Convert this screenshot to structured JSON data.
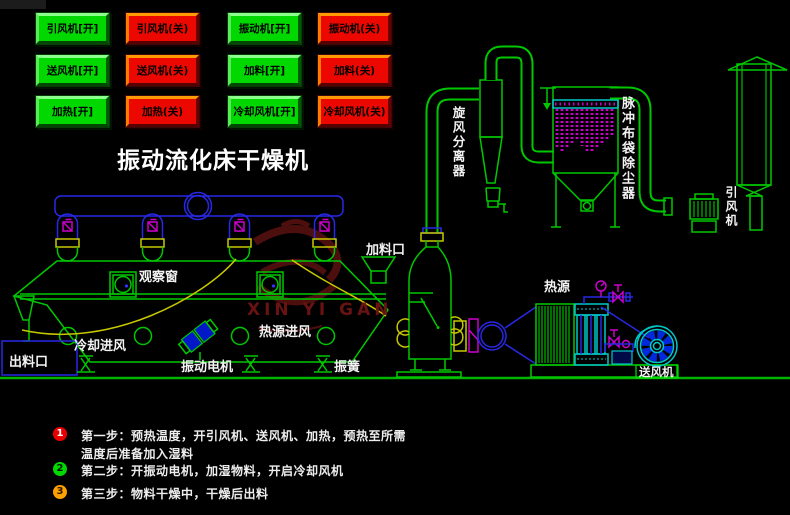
{
  "title": "振动流化床干燥机",
  "control_panel": {
    "on_color": "#00d800",
    "off_color": "#ec0800",
    "buttons": [
      {
        "label": "引风机[开]",
        "state": "on"
      },
      {
        "label": "引风机(关)",
        "state": "off"
      },
      {
        "label": "振动机[开]",
        "state": "on"
      },
      {
        "label": "振动机(关)",
        "state": "off"
      },
      {
        "label": "送风机[开]",
        "state": "on"
      },
      {
        "label": "送风机(关)",
        "state": "off"
      },
      {
        "label": "加料[开]",
        "state": "on"
      },
      {
        "label": "加料(关)",
        "state": "off"
      },
      {
        "label": "加热[开]",
        "state": "on"
      },
      {
        "label": "加热(关)",
        "state": "off"
      },
      {
        "label": "冷却风机[开]",
        "state": "on"
      },
      {
        "label": "冷却风机(关)",
        "state": "off"
      }
    ]
  },
  "equipment_labels": {
    "observation_window": "观察窗",
    "feed_port": "加料口",
    "cooling_air_inlet": "冷却进风",
    "heat_air_inlet": "热源进风",
    "vibration_motor": "振动电机",
    "discharge_port": "出料口",
    "vibration_spring": "振簧",
    "heat_source": "热源",
    "blower_fan": "送风机",
    "cyclone_separator": "旋风分离器",
    "pulse_bag_filter": "脉冲布袋除尘器",
    "induced_draft_fan": "引风机"
  },
  "watermark": {
    "text": "XIN YI GAN"
  },
  "steps": [
    {
      "num": "1",
      "badge_color": "#e80000",
      "lines": [
        "第一步：预热温度，开引风机、送风机、加热，预热至所需",
        "温度后准备加入湿料"
      ]
    },
    {
      "num": "2",
      "badge_color": "#00d800",
      "lines": [
        "第二步：开振动电机，加湿物料，开启冷却风机"
      ]
    },
    {
      "num": "3",
      "badge_color": "#ffa000",
      "lines": [
        "第三步：物料干燥中，干燥后出料"
      ]
    }
  ],
  "diagram_colors": {
    "line_green": "#00c800",
    "line_blue": "#2828e6",
    "line_yellow": "#c8c800",
    "line_magenta": "#cc00cc",
    "line_cyan": "#00c8c8",
    "watermark_red": "#4d0e0e"
  }
}
